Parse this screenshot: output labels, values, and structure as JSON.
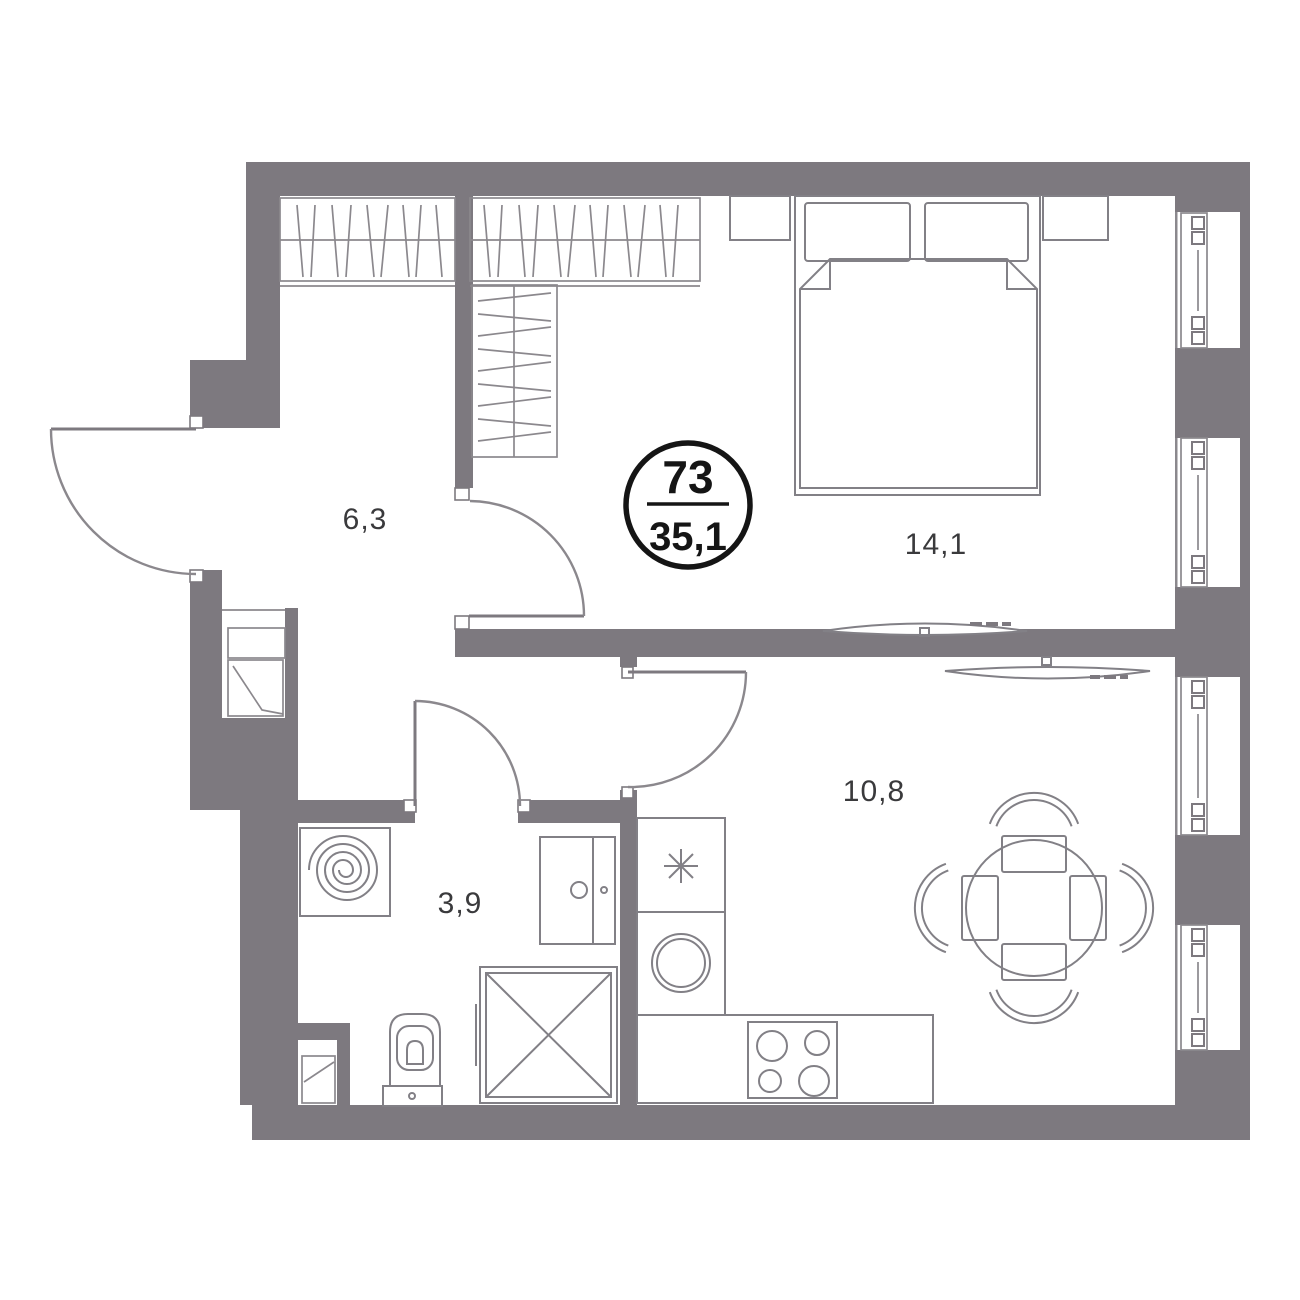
{
  "unit_badge": {
    "number": "73",
    "area": "35,1"
  },
  "rooms": [
    {
      "id": "hallway",
      "area_label": "6,3"
    },
    {
      "id": "bedroom",
      "area_label": "14,1"
    },
    {
      "id": "kitchen-living",
      "area_label": "10,8"
    },
    {
      "id": "bathroom",
      "area_label": "3,9"
    }
  ],
  "fixtures": [
    "entrance-door",
    "bedroom-door",
    "bathroom-door",
    "kitchen-door",
    "wardrobe-hallway",
    "wardrobe-bedroom",
    "wardrobe-tall",
    "double-bed",
    "pillow-left",
    "pillow-right",
    "blanket",
    "nightstand-left",
    "nightstand-right",
    "tv-bedroom",
    "tv-kitchen",
    "window",
    "facade-pillar",
    "fridge-snowflake",
    "kitchen-sink",
    "stove-4-burners",
    "dining-table",
    "chair",
    "washing-machine",
    "vanity-cabinet",
    "toilet",
    "shower-cabin",
    "utility-shaft"
  ],
  "colors": {
    "wall": "#7d797f",
    "line": "#8b888d",
    "furn": "#828086",
    "text": "#3a3a3c",
    "badge": "#151515",
    "bg": "#ffffff"
  }
}
